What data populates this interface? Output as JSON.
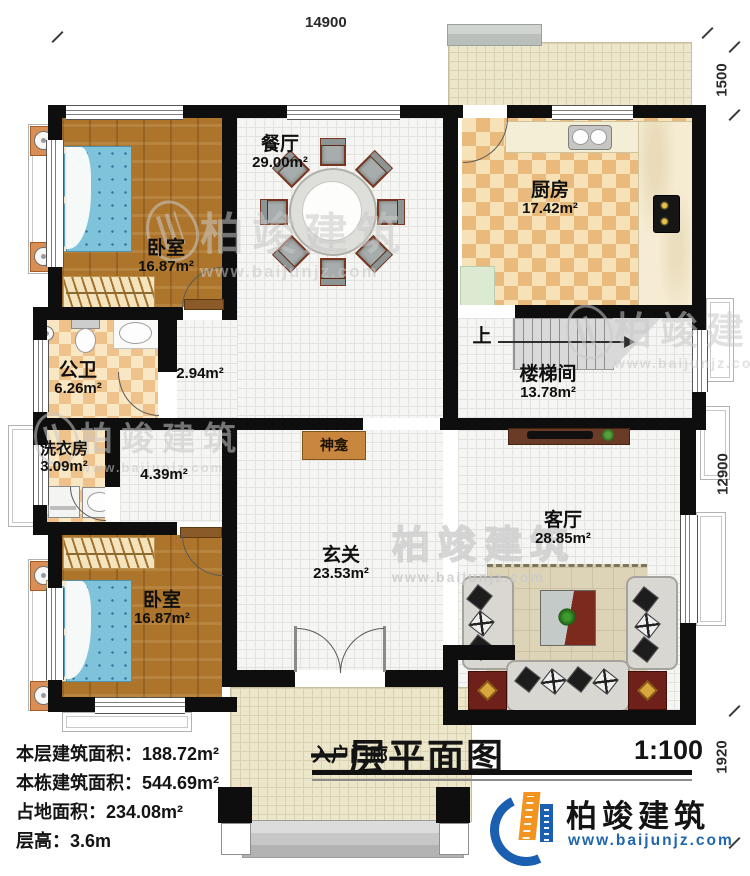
{
  "title": {
    "main": "一层平面图",
    "scale": "1:100"
  },
  "dimensions": {
    "top": "14900",
    "right_top": "1500",
    "right_middle": "12900",
    "right_bottom": "1920"
  },
  "rooms": {
    "bedroom1": {
      "name": "卧室",
      "area": "16.87m²"
    },
    "dining": {
      "name": "餐厅",
      "area": "29.00m²"
    },
    "kitchen": {
      "name": "厨房",
      "area": "17.42m²"
    },
    "bathroom": {
      "name": "公卫",
      "area": "6.26m²"
    },
    "hall_a": {
      "area": "2.94m²"
    },
    "laundry": {
      "name": "洗衣房",
      "area": "3.09m²"
    },
    "hall_b": {
      "area": "4.39m²"
    },
    "stairwell": {
      "name": "楼梯间",
      "area": "13.78m²"
    },
    "foyer": {
      "name": "玄关",
      "area": "23.53m²"
    },
    "living": {
      "name": "客厅",
      "area": "28.85m²"
    },
    "bedroom2": {
      "name": "卧室",
      "area": "16.87m²"
    },
    "porch": {
      "name": "入户门廊"
    },
    "shrine": {
      "name": "神龛"
    },
    "stairs_up": {
      "label": "上"
    }
  },
  "info": {
    "line1": "本层建筑面积：188.72m²",
    "line2": "本栋建筑面积：544.69m²",
    "line3": "占地面积：234.08m²",
    "line4": "层高：3.6m"
  },
  "logo": {
    "name": "柏竣建筑",
    "url": "www.baijunjz.com"
  },
  "watermark": {
    "text": "柏竣建筑",
    "url": "www.baijunjz.com"
  },
  "colors": {
    "wall": "#0e0e0e",
    "wood_floor": "#ad752c",
    "kitchen_checker": "#eaba7c",
    "logo_blue": "#1b5fb0",
    "logo_orange": "#f2941f",
    "shrine_brown": "#c8863f"
  }
}
